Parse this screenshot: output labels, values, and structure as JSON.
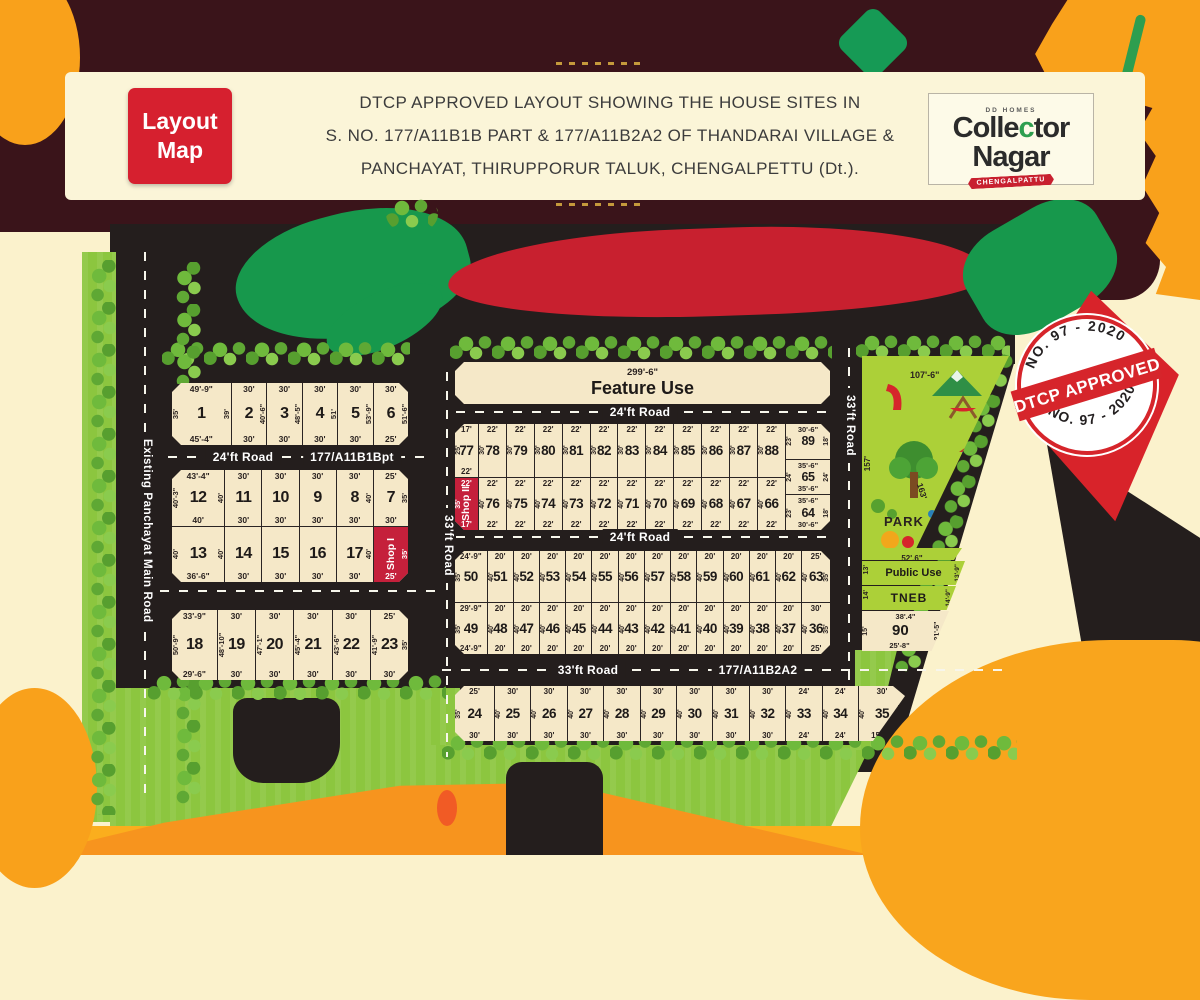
{
  "header": {
    "badge_line1": "Layout",
    "badge_line2": "Map",
    "title_line1": "DTCP APPROVED LAYOUT SHOWING THE HOUSE SITES IN",
    "title_line2": "S. NO. 177/A11B1B PART & 177/A11B2A2 OF THANDARAI VILLAGE &",
    "title_line3": "PANCHAYAT, THIRUPPORUR TALUK, CHENGALPETTU (Dt.).",
    "logo": {
      "brand": "DD HOMES",
      "name_part1": "Colle",
      "name_accent": "c",
      "name_part2": "tor",
      "name_line2": "Nagar",
      "ribbon": "CHENGALPATTU"
    }
  },
  "stamp": {
    "arc_top": "NO. 97 - 2020",
    "band": "DTCP APPROVED",
    "arc_bottom": "NO. 97 - 2020"
  },
  "roads": {
    "left_vertical": "Existing Panchayat Main Road",
    "road24_left": "24'ft Road",
    "survey_left": "177/A11B1Bpt",
    "road33_center_vertical": "33'ft Road",
    "road24_center_top": "24'ft Road",
    "road24_center_mid": "24'ft Road",
    "road33_bottom": "33'ft Road",
    "survey_right": "177/A11B2A2",
    "road33_right_vertical": "33'ft Road"
  },
  "feature_use": {
    "width": "299'-6\"",
    "label": "Feature Use"
  },
  "park": {
    "label": "PARK",
    "dim_top": "107'-6\"",
    "dim_left": "157'",
    "dim_right": "163'",
    "dim_bottom": "52'.6\""
  },
  "public_use": {
    "label": "Public Use",
    "dim_left": "13'",
    "dim_right": "13'-9\""
  },
  "tneb": {
    "label": "TNEB",
    "dim_left": "14'",
    "dim_right": "14'-9\""
  },
  "plot_90": {
    "n": "90",
    "t": "38'.4\"",
    "b": "25'-8\"",
    "l": "15'",
    "r": "21'-5\""
  },
  "colors": {
    "accent_red": "#D6202F",
    "shop_red": "#C5203B",
    "park_green": "#ACD038",
    "plot_cream": "#F5E8C8",
    "road_black": "#241E1D",
    "maroon": "#3A141A",
    "orange": "#F9A11B",
    "grass_green": "#8CC63F"
  },
  "blocks": {
    "b1": [
      {
        "n": "1",
        "t": "49'-9\"",
        "b": "45'-4\"",
        "l": "35'",
        "r": "39'",
        "w": 1.7
      },
      {
        "n": "2",
        "t": "30'",
        "b": "30'",
        "r": "40'-6\""
      },
      {
        "n": "3",
        "t": "30'",
        "b": "30'",
        "r": "48'-5\""
      },
      {
        "n": "4",
        "t": "30'",
        "b": "30'",
        "r": "51'"
      },
      {
        "n": "5",
        "t": "30'",
        "b": "30'",
        "r": "53'-9\""
      },
      {
        "n": "6",
        "t": "30'",
        "b": "25'",
        "r": "51'-6\""
      }
    ],
    "b2": [
      {
        "n": "12",
        "t": "43'-4\"",
        "b": "40'",
        "l": "40'-3\"",
        "r": "40'",
        "w": 1.45
      },
      {
        "n": "11",
        "t": "30'",
        "b": "30'"
      },
      {
        "n": "10",
        "t": "30'",
        "b": "30'"
      },
      {
        "n": "9",
        "t": "30'",
        "b": "30'"
      },
      {
        "n": "8",
        "t": "30'",
        "b": "30'",
        "r": "40'"
      },
      {
        "n": "7",
        "t": "25'",
        "b": "30'",
        "r": "35'",
        "w": 0.95
      }
    ],
    "b3": [
      {
        "n": "13",
        "b": "36'-6\"",
        "l": "40'",
        "r": "40'",
        "w": 1.45
      },
      {
        "n": "14",
        "b": "30'"
      },
      {
        "n": "15",
        "b": "30'"
      },
      {
        "n": "16",
        "b": "30'"
      },
      {
        "n": "17",
        "b": "30'",
        "r": "40'"
      },
      {
        "n": "Shop I",
        "shop": true,
        "b": "25'",
        "r": "35'",
        "w": 0.95
      }
    ],
    "b4": [
      {
        "n": "18",
        "t": "33'-9\"",
        "b": "29'-6\"",
        "l": "50'-9\"",
        "w": 1.2
      },
      {
        "n": "19",
        "t": "30'",
        "b": "30'",
        "l": "48'-10\""
      },
      {
        "n": "20",
        "t": "30'",
        "b": "30'",
        "l": "47'-1\""
      },
      {
        "n": "21",
        "t": "30'",
        "b": "30'",
        "l": "45'-4\""
      },
      {
        "n": "22",
        "t": "30'",
        "b": "30'",
        "l": "43'-6\""
      },
      {
        "n": "23",
        "t": "25'",
        "b": "30'",
        "l": "41'-9\"",
        "r": "35'"
      }
    ],
    "row77": [
      {
        "n": "77",
        "t": "17'",
        "b": "22'",
        "l": "25'",
        "w": 0.85
      },
      {
        "n": "78",
        "t": "22'",
        "l": "30'"
      },
      {
        "n": "79",
        "t": "22'",
        "l": "30'"
      },
      {
        "n": "80",
        "t": "22'",
        "l": "30'"
      },
      {
        "n": "81",
        "t": "22'",
        "l": "30'"
      },
      {
        "n": "82",
        "t": "22'",
        "l": "30'"
      },
      {
        "n": "83",
        "t": "22'",
        "l": "30'"
      },
      {
        "n": "84",
        "t": "22'",
        "l": "30'"
      },
      {
        "n": "85",
        "t": "22'",
        "l": "30'"
      },
      {
        "n": "86",
        "t": "22'",
        "l": "30'"
      },
      {
        "n": "87",
        "t": "22'",
        "l": "30'"
      },
      {
        "n": "88",
        "t": "22'",
        "l": "30'"
      }
    ],
    "row76": [
      {
        "n": "Shop II",
        "shop": true,
        "t": "22'",
        "b": "17'",
        "l": "35'",
        "w": 0.85
      },
      {
        "n": "76",
        "t": "22'",
        "b": "22'",
        "l": "40'"
      },
      {
        "n": "75",
        "t": "22'",
        "b": "22'",
        "l": "40'"
      },
      {
        "n": "74",
        "t": "22'",
        "b": "22'",
        "l": "40'"
      },
      {
        "n": "73",
        "t": "22'",
        "b": "22'",
        "l": "40'"
      },
      {
        "n": "72",
        "t": "22'",
        "b": "22'",
        "l": "40'"
      },
      {
        "n": "71",
        "t": "22'",
        "b": "22'",
        "l": "40'"
      },
      {
        "n": "70",
        "t": "22'",
        "b": "22'",
        "l": "40'"
      },
      {
        "n": "69",
        "t": "22'",
        "b": "22'",
        "l": "40'"
      },
      {
        "n": "68",
        "t": "22'",
        "b": "22'",
        "l": "40'"
      },
      {
        "n": "67",
        "t": "22'",
        "b": "22'",
        "l": "40'"
      },
      {
        "n": "66",
        "t": "22'",
        "b": "22'",
        "l": "40'"
      }
    ],
    "rcol": [
      {
        "n": "89",
        "t": "30'-6\"",
        "l": "23'",
        "r": "18'"
      },
      {
        "n": "65",
        "t": "35'-6\"",
        "b": "35'-6\"",
        "l": "24'",
        "r": "24'"
      },
      {
        "n": "64",
        "t": "35'-6\"",
        "b": "30'-6\"",
        "l": "23'",
        "r": "18'"
      }
    ],
    "row50": [
      {
        "n": "50",
        "t": "24'-9\"",
        "l": "35'",
        "w": 1.25
      },
      {
        "n": "51",
        "t": "20'",
        "l": "40'"
      },
      {
        "n": "52",
        "t": "20'",
        "l": "40'"
      },
      {
        "n": "53",
        "t": "20'",
        "l": "40'"
      },
      {
        "n": "54",
        "t": "20'",
        "l": "40'"
      },
      {
        "n": "55",
        "t": "20'",
        "l": "40'"
      },
      {
        "n": "56",
        "t": "20'",
        "l": "40'"
      },
      {
        "n": "57",
        "t": "20'",
        "l": "40'"
      },
      {
        "n": "58",
        "t": "20'",
        "l": "40'"
      },
      {
        "n": "59",
        "t": "20'",
        "l": "40'"
      },
      {
        "n": "60",
        "t": "20'",
        "l": "40'"
      },
      {
        "n": "61",
        "t": "20'",
        "l": "40'"
      },
      {
        "n": "62",
        "t": "20'",
        "l": "40'"
      },
      {
        "n": "63",
        "t": "25'",
        "l": "40'",
        "r": "35'",
        "w": 1.1
      }
    ],
    "row49": [
      {
        "n": "49",
        "t": "29'-9\"",
        "b": "24'-9\"",
        "l": "35'",
        "w": 1.25
      },
      {
        "n": "48",
        "t": "20'",
        "b": "20'",
        "l": "40'"
      },
      {
        "n": "47",
        "t": "20'",
        "b": "20'",
        "l": "40'"
      },
      {
        "n": "46",
        "t": "20'",
        "b": "20'",
        "l": "40'"
      },
      {
        "n": "45",
        "t": "20'",
        "b": "20'",
        "l": "40'"
      },
      {
        "n": "44",
        "t": "20'",
        "b": "20'",
        "l": "40'"
      },
      {
        "n": "43",
        "t": "20'",
        "b": "20'",
        "l": "40'"
      },
      {
        "n": "42",
        "t": "20'",
        "b": "20'",
        "l": "40'"
      },
      {
        "n": "41",
        "t": "20'",
        "b": "20'",
        "l": "40'"
      },
      {
        "n": "40",
        "t": "20'",
        "b": "20'",
        "l": "40'"
      },
      {
        "n": "39",
        "t": "20'",
        "b": "20'",
        "l": "40'"
      },
      {
        "n": "38",
        "t": "20'",
        "b": "20'",
        "l": "40'"
      },
      {
        "n": "37",
        "t": "20'",
        "b": "20'",
        "l": "40'"
      },
      {
        "n": "36",
        "t": "30'",
        "b": "25'",
        "l": "40'",
        "r": "35'",
        "w": 1.1
      }
    ],
    "row24": [
      {
        "n": "24",
        "t": "25'",
        "b": "30'",
        "l": "35'",
        "w": 1.1
      },
      {
        "n": "25",
        "t": "30'",
        "b": "30'",
        "l": "40'"
      },
      {
        "n": "26",
        "t": "30'",
        "b": "30'",
        "l": "40'"
      },
      {
        "n": "27",
        "t": "30'",
        "b": "30'",
        "l": "40'"
      },
      {
        "n": "28",
        "t": "30'",
        "b": "30'",
        "l": "40'"
      },
      {
        "n": "29",
        "t": "30'",
        "b": "30'",
        "l": "40'"
      },
      {
        "n": "30",
        "t": "30'",
        "b": "30'",
        "l": "40'"
      },
      {
        "n": "31",
        "t": "30'",
        "b": "30'",
        "l": "40'"
      },
      {
        "n": "32",
        "t": "30'",
        "b": "30'",
        "l": "40'"
      },
      {
        "n": "33",
        "t": "24'",
        "b": "24'",
        "l": "40'"
      },
      {
        "n": "34",
        "t": "24'",
        "b": "24'",
        "l": "40'"
      },
      {
        "n": "35",
        "t": "30'",
        "b": "15'-2\"",
        "l": "40'",
        "r": "42'-6\"",
        "w": 1.3
      }
    ]
  }
}
